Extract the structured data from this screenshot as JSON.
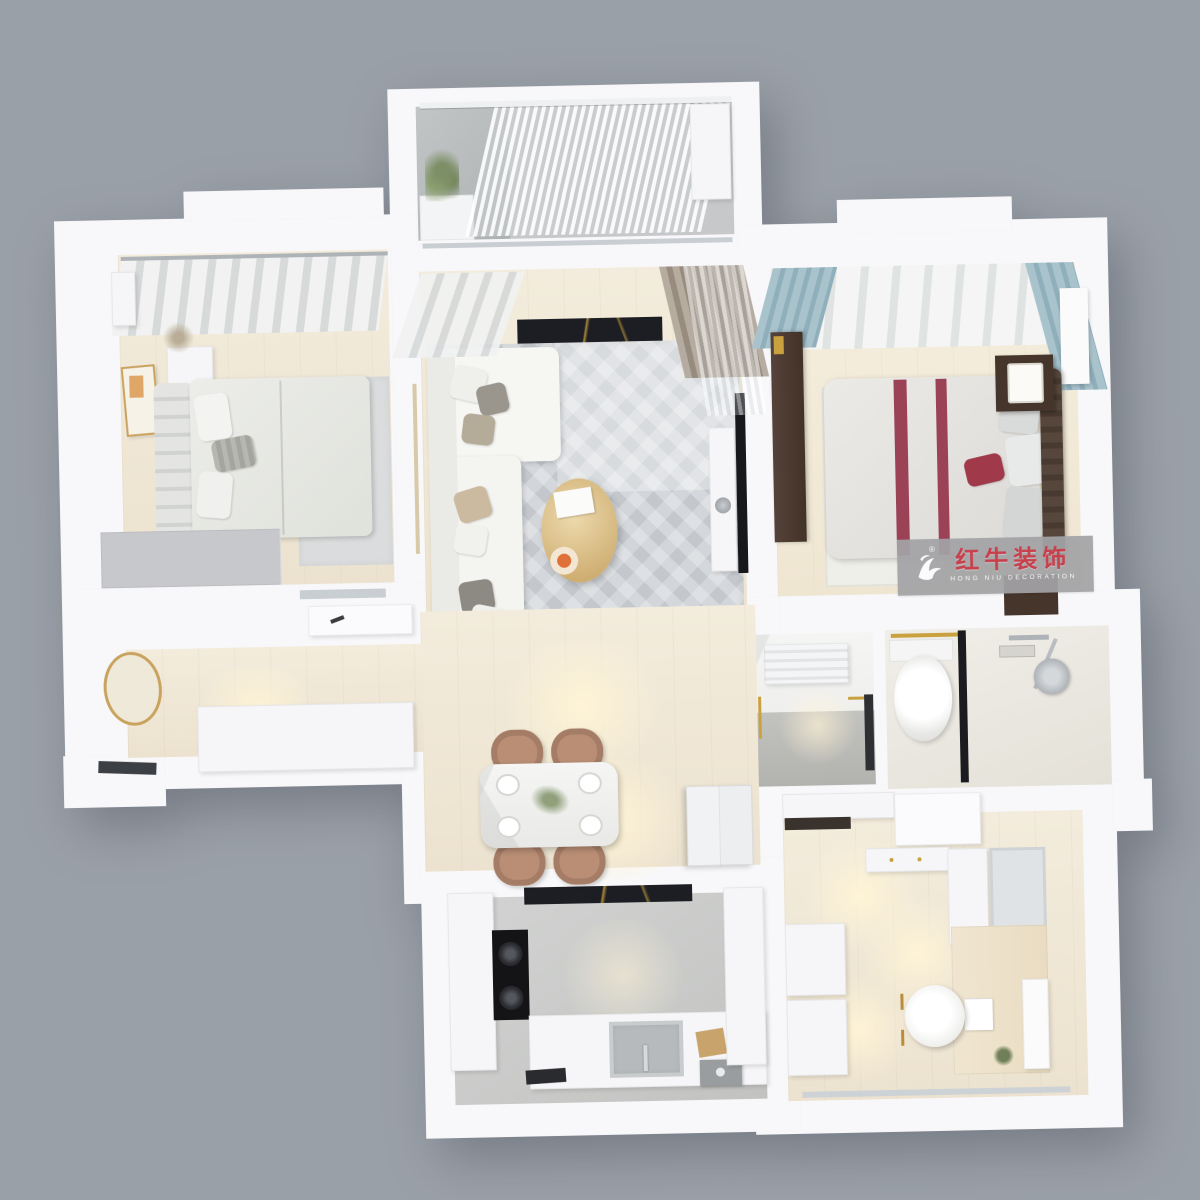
{
  "watermark": {
    "brand_cn": "红牛装饰",
    "brand_en": "HONG NIU DECORATION",
    "registered_mark": "®"
  },
  "palette": {
    "background_gray": "#9aa0a8",
    "wall_white": "#f8f8fa",
    "wood_floor": "#f0e8d6",
    "rug_gray": "#cdd1d5",
    "kitchen_floor_gray": "#cbcccb",
    "accent_red_stripe": "#9c4256",
    "brand_red": "#c8404c",
    "curtain_blue": "#a9c3cd",
    "dark_wood": "#4a382e",
    "gold_accent": "#c9a23f",
    "tv_marble_black": "#1d1e23",
    "dining_chair_tan": "#b98e75",
    "warm_light": "#fff3d6"
  }
}
